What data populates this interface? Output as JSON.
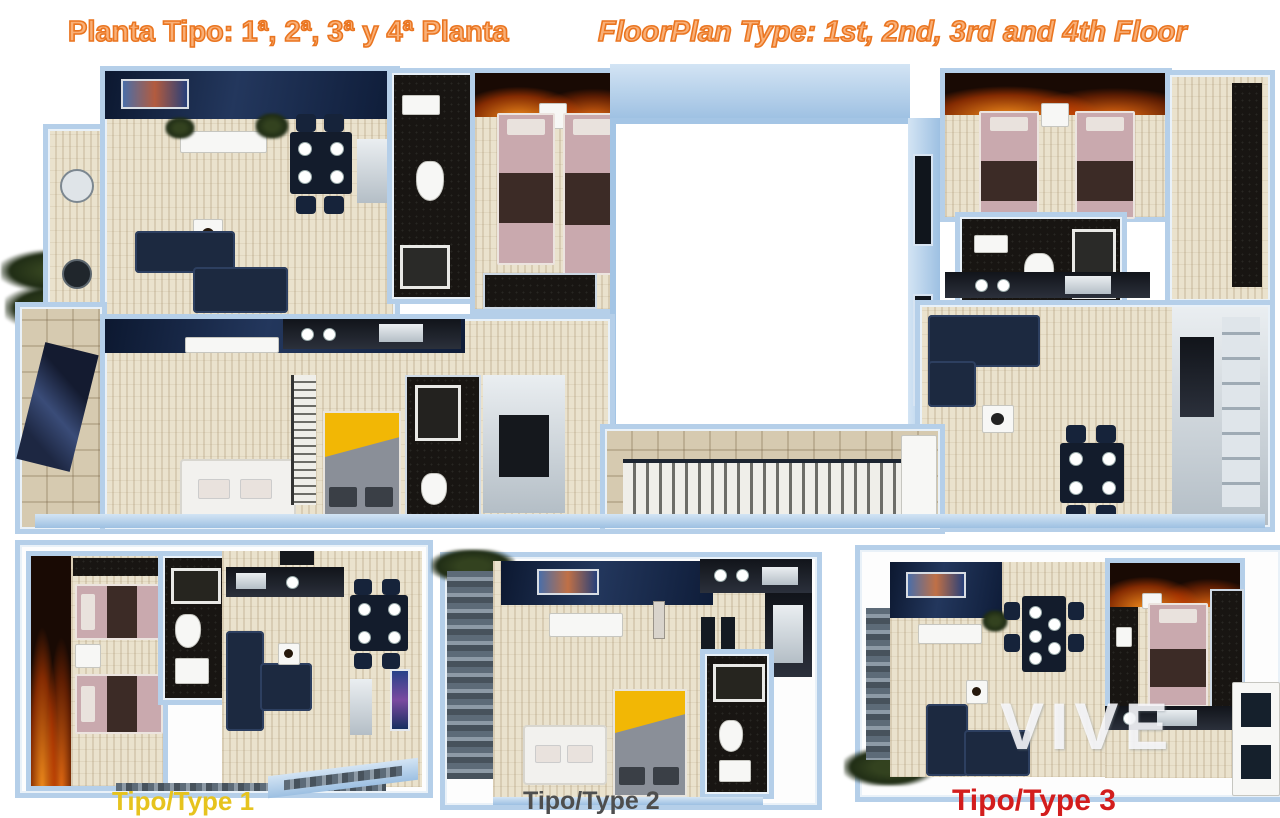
{
  "header": {
    "title_left": "Planta Tipo: 1ª, 2ª, 3ª y 4ª Planta",
    "title_right": "FloorPlan Type: 1st, 2nd, 3rd and 4th Floor",
    "title_color": "#ea7520"
  },
  "unit_labels": [
    {
      "text": "Tipo/Type 1",
      "color": "#e6c31e"
    },
    {
      "text": "Tipo/Type 2",
      "color": "#4e4e4e"
    },
    {
      "text": "Tipo/Type 3",
      "color": "#d31d1d"
    }
  ],
  "watermark": {
    "text": "VIVE",
    "color": "rgba(252,252,255,0.85)"
  },
  "palette": {
    "background": "#ffffff",
    "wall_blue": "#9dc0e2",
    "wall_blue_light": "#d3e4f4",
    "floor_beige": "#eae2cd",
    "tile_tan": "#d6cab0",
    "navy_accent_wall": "#16294d",
    "navy_furniture": "#1c2940",
    "dark_bathroom": "#181512",
    "bed_pink": "#c9a9ae",
    "bed_yellow": "#f2b705",
    "fire_accent_orange": "#ff8c1e",
    "plant_green": "#2c3a1d",
    "white_furniture": "#f7f7f5"
  }
}
